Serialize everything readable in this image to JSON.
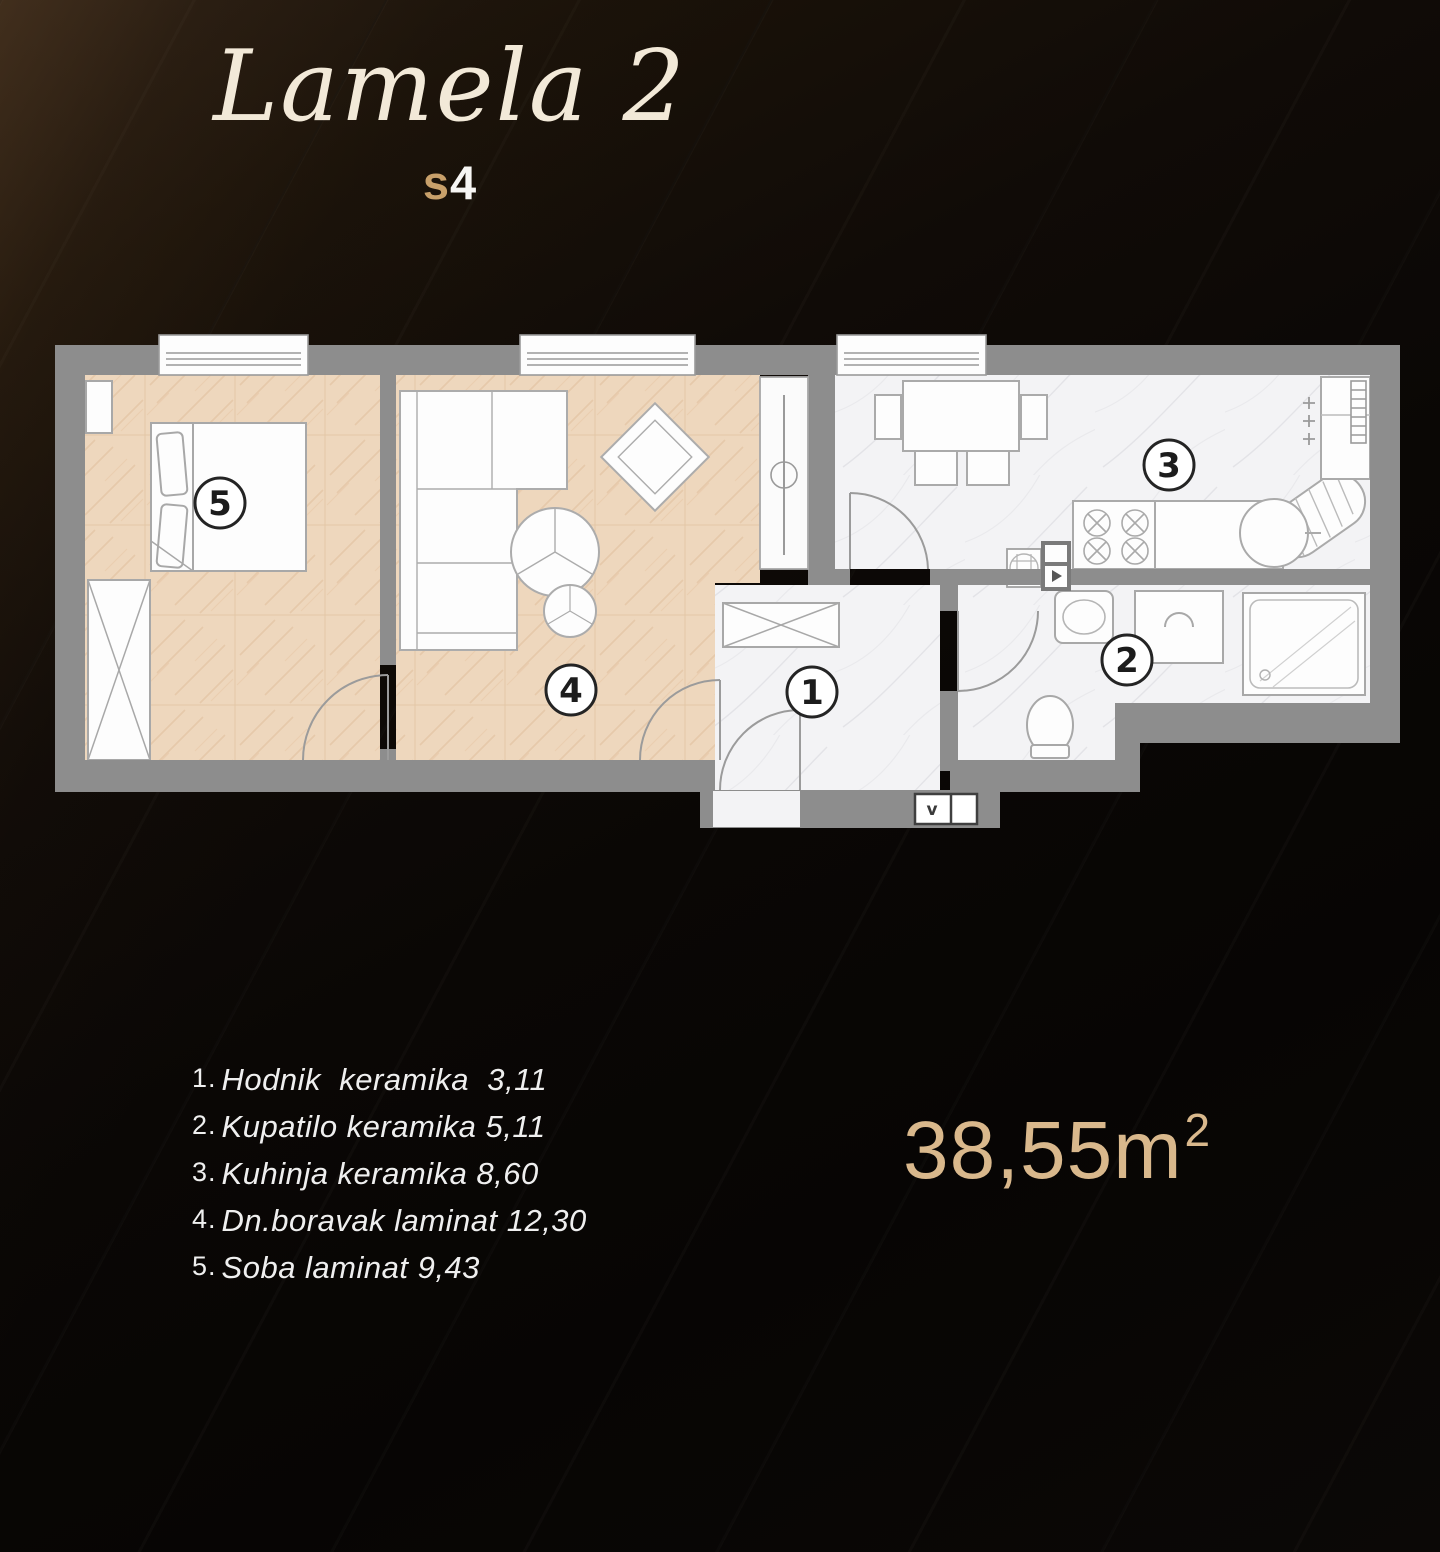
{
  "header": {
    "title": "Lamela 2",
    "unit_prefix": "s",
    "unit_number": "4"
  },
  "floor_plan": {
    "room_numbers": {
      "hallway": "1",
      "bathroom": "2",
      "kitchen": "3",
      "living_room": "4",
      "bedroom": "5"
    },
    "vent_label": "v"
  },
  "legend": {
    "items": [
      {
        "number": "1.",
        "label": "Hodnik  keramika  3,11"
      },
      {
        "number": "2.",
        "label": "Kupatilo keramika 5,11"
      },
      {
        "number": "3.",
        "label": "Kuhinja keramika 8,60"
      },
      {
        "number": "4.",
        "label": "Dn.boravak laminat 12,30"
      },
      {
        "number": "5.",
        "label": "Soba laminat 9,43"
      }
    ]
  },
  "total_area": {
    "value": "38,55m",
    "superscript": "2"
  },
  "colors": {
    "title_cream": "#f2e9d8",
    "accent_gold": "#c8a06a",
    "area_text": "#d9b88c",
    "wall_gray": "#8d8d8d",
    "laminate": "#eed7bd",
    "ceramic": "#f3f3f5",
    "background": "#0b0806"
  }
}
